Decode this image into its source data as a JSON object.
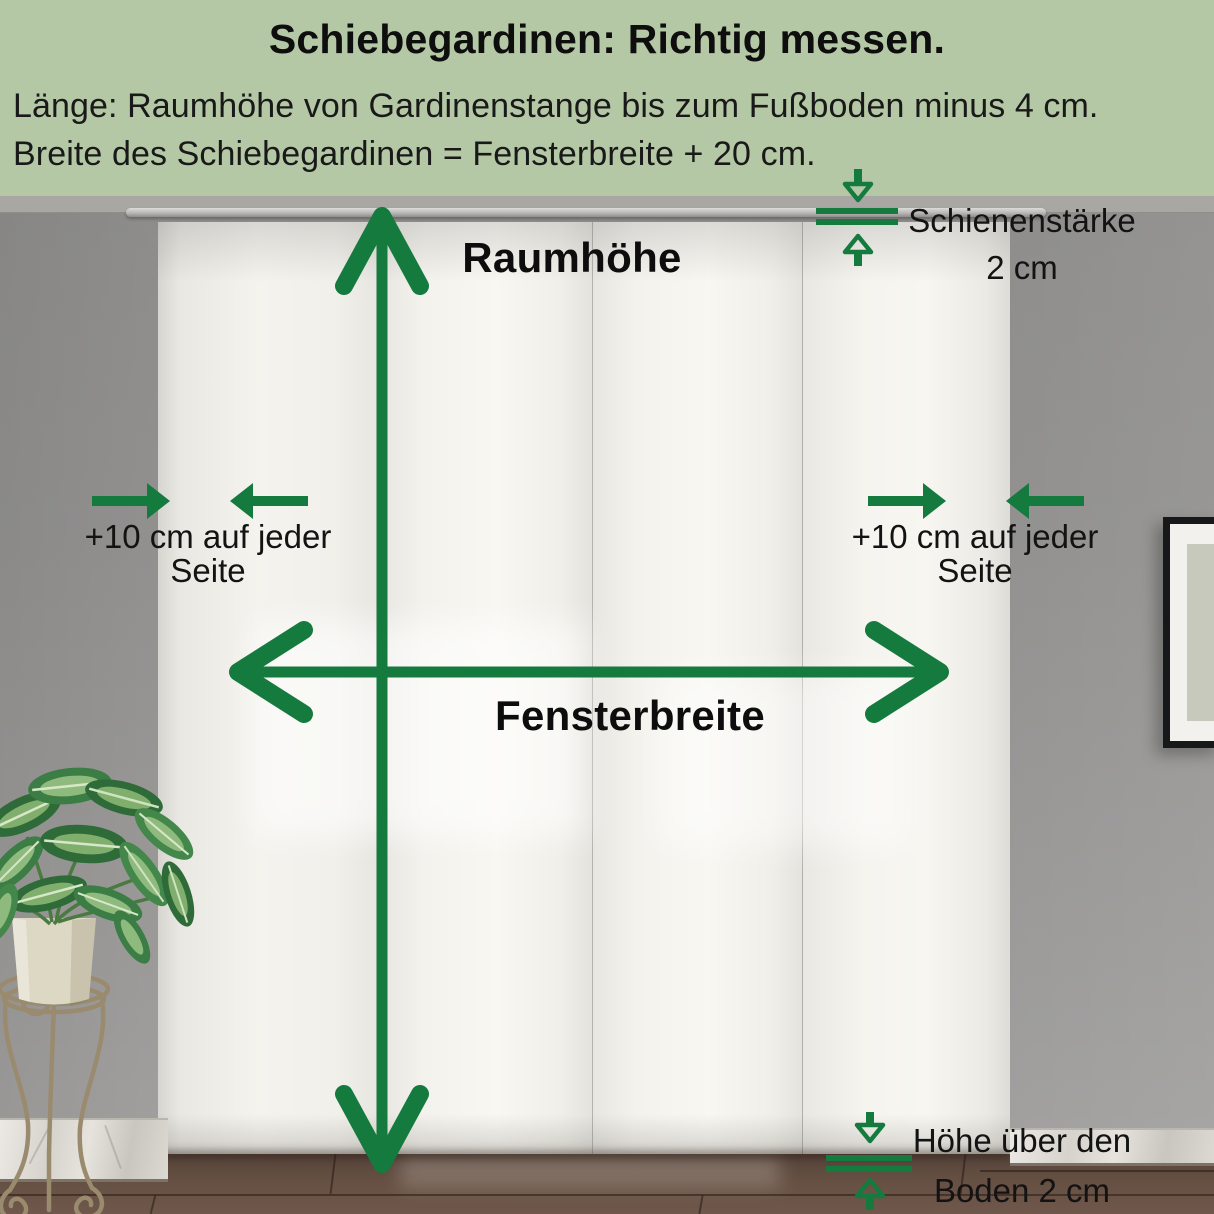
{
  "header": {
    "title": "Schiebegardinen: Richtig messen.",
    "line1": "Länge: Raumhöhe von Gardinenstange bis zum Fußboden minus 4 cm.",
    "line2": "Breite des Schiebegardinen = Fensterbreite + 20 cm.",
    "background_color": "#b5c8a5"
  },
  "annotations": {
    "accent_green": "#157a3e",
    "room_height": {
      "label": "Raumhöhe"
    },
    "window_width": {
      "label": "Fensterbreite"
    },
    "left_side": {
      "line1": "+10 cm auf jeder",
      "line2": "Seite"
    },
    "right_side": {
      "line1": "+10 cm auf jeder",
      "line2": "Seite"
    },
    "rail_thickness": {
      "line1": "Schienenstärke",
      "line2": "2 cm"
    },
    "floor_clearance": {
      "line1": "Höhe über den",
      "line2": "Boden 2 cm"
    }
  }
}
